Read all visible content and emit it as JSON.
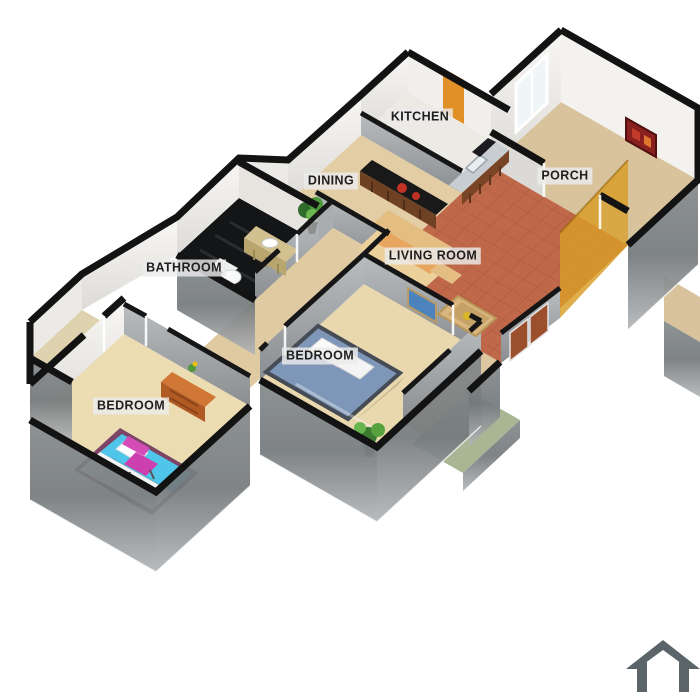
{
  "scene": {
    "type": "3d-floor-plan-cutaway-render",
    "background": "#ffffff"
  },
  "rooms": [
    {
      "id": "kitchen",
      "label": "KITCHEN"
    },
    {
      "id": "dining",
      "label": "DINING"
    },
    {
      "id": "porch",
      "label": "PORCH"
    },
    {
      "id": "bathroom",
      "label": "BATHROOM"
    },
    {
      "id": "living_room",
      "label": "LIVING ROOM"
    },
    {
      "id": "bedroom_main",
      "label": "BEDROOM"
    },
    {
      "id": "bedroom_second",
      "label": "BEDROOM"
    }
  ],
  "logo": {
    "icon": "house-outline-icon",
    "color": "#5b6569"
  },
  "palette": {
    "wall_cap": "#131313",
    "white_wall": "#f4f2ef",
    "gray_wall": "#9aa0a3",
    "living_floor": "#c0684a",
    "beige_floor": "#e3cda5",
    "bedroom_floor": "#e9d8ad",
    "porch_floor": "#d8c39d",
    "kitchen_floor": "#eceae4",
    "bathroom_floor": "#141517",
    "patio_green": "#a9b694",
    "amber_wall": "rgba(216,156,38,0.82)",
    "bed_blue": "#7e97b8",
    "bed_cyan": "#4fc6e9",
    "chair_pink": "#cb3fae",
    "sofa_cream": "#ecd09c",
    "wood_brown": "#b05a24",
    "door_brown": "#9c4f2c",
    "backsplash_orange": "#e09026",
    "picture_red": "#8a1f1f",
    "plant_green": "#4e9a3c"
  }
}
